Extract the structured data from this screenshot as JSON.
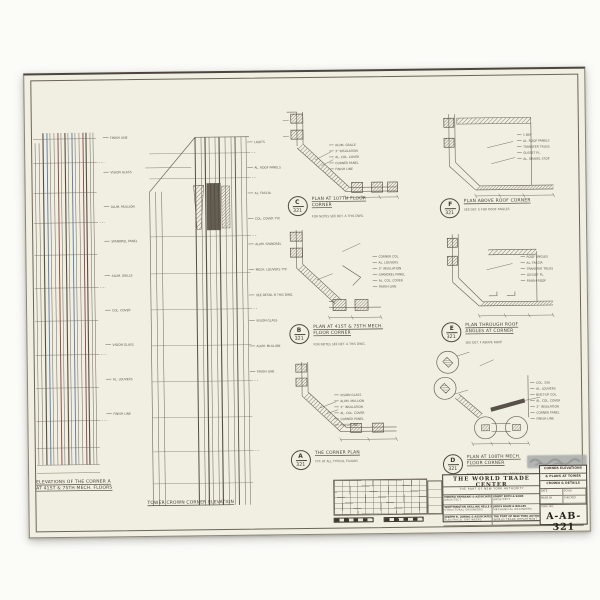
{
  "sheet": {
    "captions": {
      "left_elevation_line1": "ELEVATIONS OF THE CORNER A",
      "left_elevation_line2": "AT 41ST & 75TH MECH. FLOORS",
      "middle_elevation": "TOWER CROWN CORNER ELEVATION"
    },
    "elevation_labels_left": [
      "FINISH LINE",
      "VISION GLASS",
      "ALUM. MULLION",
      "SPANDREL PANEL",
      "ALUM. GRILLE",
      "COL. COVER",
      "VISION GLASS",
      "AL. LOUVERS",
      "FINISH LINE"
    ],
    "elevation_labels_mid": [
      "LIGHTS",
      "AL. ROOF PANELS",
      "AL. FASCIA",
      "COL. COVER TYP.",
      "ALUM. SPANDREL",
      "MECH. LOUVERS TYP.",
      "SEE DETAIL B THIS DWG.",
      "VISION GLASS",
      "ALUM. MULLION",
      "FINISH LINE"
    ],
    "details": [
      {
        "id": "C",
        "no": "321",
        "caption": "PLAN AT 107TH FLOOR CORNER",
        "note": "FOR NOTES SEE DET. A THIS DWG.",
        "annotations": [
          "ALUM. GRILLE",
          "3'' INSULATION",
          "AL. COL. COVER",
          "CORNER PANEL",
          "FINISH LINE"
        ]
      },
      {
        "id": "F",
        "no": "321",
        "caption": "PLAN ABOVE ROOF CORNER",
        "note": "SEE DET. E FOR ROOF ANGLES",
        "annotations": [
          "1 BAY",
          "AL. ROOF PANELS",
          "TRANSFER TRUSS",
          "GUSSET PL.",
          "AL. GRAVEL STOP"
        ]
      },
      {
        "id": "B",
        "no": "321",
        "caption": "PLAN AT 41ST & 75TH MECH. FLOOR CORNER",
        "note": "FOR NOTES SEE DET. A THIS DWG.",
        "annotations": [
          "CORNER COL.",
          "AL. LOUVERS",
          "3'' INSULATION",
          "SPANDREL PANEL",
          "AL. COL. COVER",
          "FINISH LINE"
        ]
      },
      {
        "id": "E",
        "no": "321",
        "caption": "PLAN THROUGH ROOF ANGLES AT CORNER",
        "note": "SEE DET. F ABOVE ROOF",
        "annotations": [
          "ROOF ANGLES",
          "AL. FASCIA",
          "TRANSFER TRUSS",
          "GUSSET PL.",
          "FINISH ROOF"
        ]
      },
      {
        "id": "A",
        "no": "321",
        "caption": "THE CORNER PLAN",
        "note": "TYP. AT ALL TYPICAL FLOORS",
        "annotations": [
          "VISION GLASS",
          "ALUM. MULLION",
          "3'' INSULATION",
          "AL. COL. COVER",
          "CORNER PANEL",
          "FINISH LINE"
        ]
      },
      {
        "id": "D",
        "no": "321",
        "caption": "PLAN AT 108TH MECH. FLOOR CORNER",
        "note": "NOTE: SEE ENLARGED COL. DETAILS",
        "annotations": [
          "COL. 339",
          "AL. LOUVERS",
          "BUILT-UP COL.",
          "AL. COL. COVER",
          "3'' INSULATION",
          "CORNER PANEL",
          "FINISH LINE"
        ]
      }
    ],
    "title_block": {
      "project": "THE WORLD TRADE CENTER",
      "authority": "THE PORT OF NEW YORK AUTHORITY",
      "firms": [
        {
          "name": "MINORU YAMASAKI & ASSOCIATES",
          "role": "ARCHITECT"
        },
        {
          "name": "EMERY ROTH & SONS",
          "role": "ARCHITECT"
        },
        {
          "name": "WORTHINGTON SKILLING HELLE & JACKSON",
          "role": "STRUCTURAL ENGINEERS"
        },
        {
          "name": "JAROS BAUM & BOLLES",
          "role": "MECHANICAL ENGINEERS"
        },
        {
          "name": "JOSEPH R. LORING & ASSOCIATES",
          "role": "ELECTRICAL ENGINEERS"
        },
        {
          "name": "THE PORT OF NEW YORK AUTHORITY",
          "role": "WORLD TRADE DEPARTMENT"
        }
      ],
      "sheet_title_lines": [
        "CORNER ELEVATIONS",
        "& PLANS AT TOWER",
        "CROWN & DETAILS"
      ],
      "fields": [
        {
          "label": "DATE",
          "value": ""
        },
        {
          "label": "SCALE",
          "value": ""
        },
        {
          "label": "MADE BY",
          "value": ""
        },
        {
          "label": "CHECKED",
          "value": ""
        }
      ],
      "drawing_no_label": "DWG. NO.",
      "drawing_number": "A-AB-321"
    },
    "colors": {
      "paper": "#f1eee2",
      "ink": "#6b6459",
      "ink_dark": "#4e483f",
      "blue_line": "#5b79a6",
      "maroon_line": "#84443e"
    }
  }
}
